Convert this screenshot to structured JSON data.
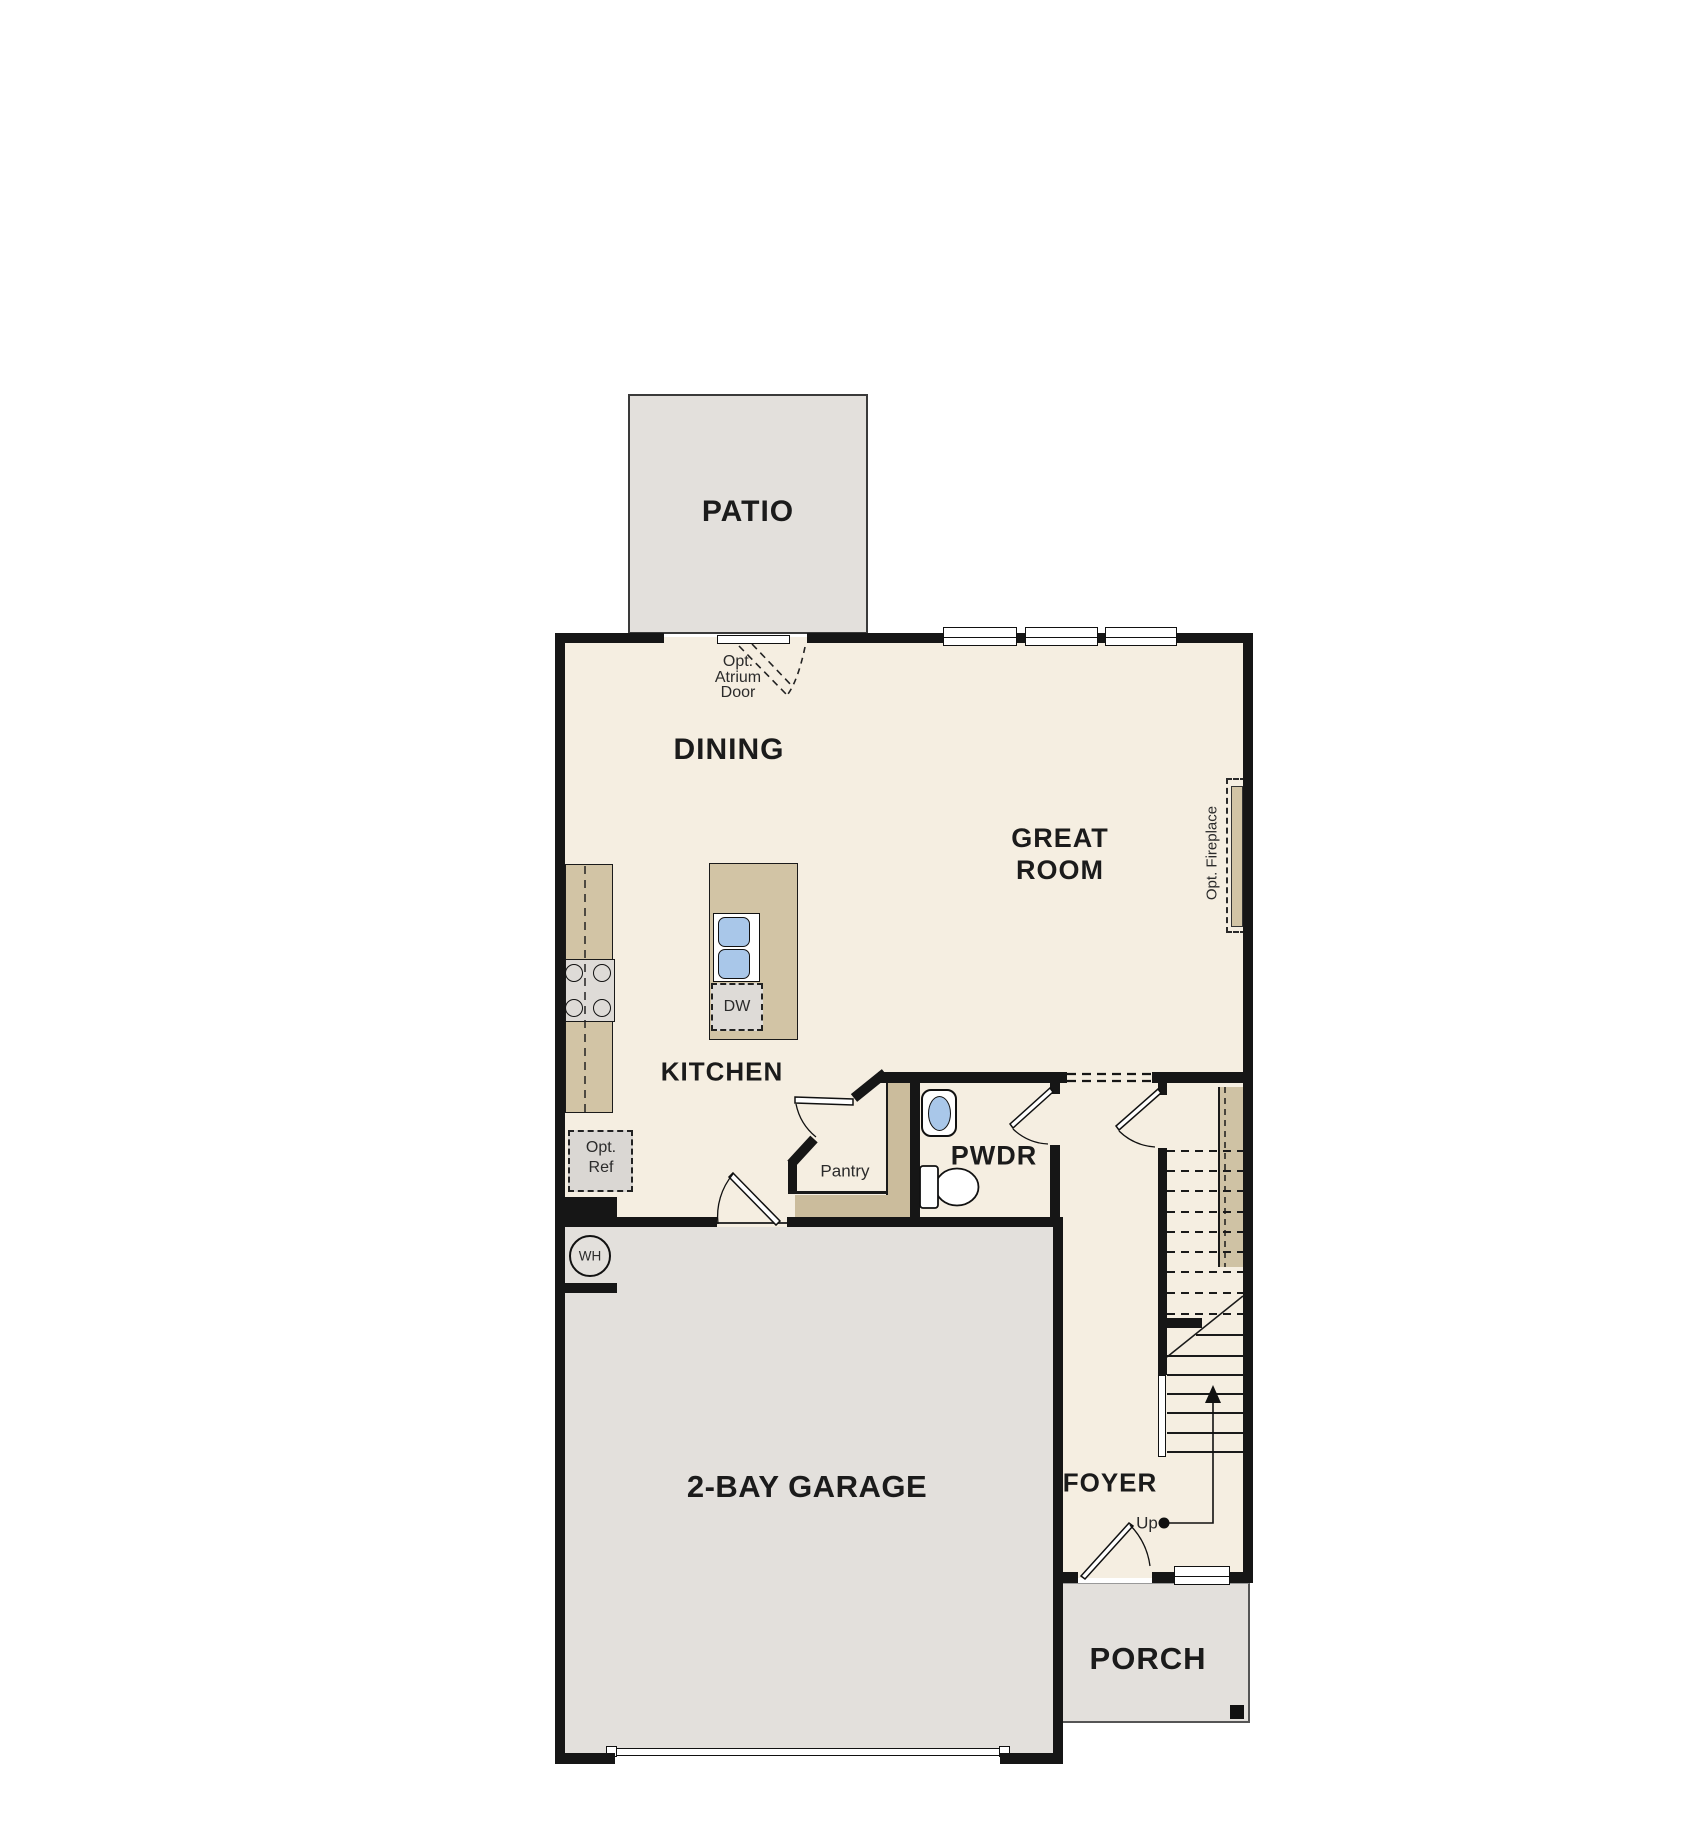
{
  "floorplan": {
    "rooms": {
      "patio": "PATIO",
      "dining": "DINING",
      "great_room_l1": "GREAT",
      "great_room_l2": "ROOM",
      "kitchen": "KITCHEN",
      "pantry": "Pantry",
      "powder": "PWDR",
      "foyer": "FOYER",
      "garage": "2-BAY GARAGE",
      "porch": "PORCH"
    },
    "annotations": {
      "atrium_l1": "Opt.",
      "atrium_l2": "Atrium",
      "atrium_l3": "Door",
      "fireplace": "Opt. Fireplace",
      "ref_l1": "Opt.",
      "ref_l2": "Ref",
      "dishwasher": "DW",
      "water_heater": "WH",
      "up": "Up"
    },
    "colors": {
      "floor_cream": "#f5eee1",
      "exterior_gray": "#e3e0dc",
      "counter_tan": "#d2c4a5",
      "counter_dark_tan": "#cbbc9c",
      "appliance_gray": "#dedbd7",
      "ref_gray": "#dad7d3",
      "fixture_blue": "#a9c7e9",
      "wall_black": "#161616"
    }
  }
}
